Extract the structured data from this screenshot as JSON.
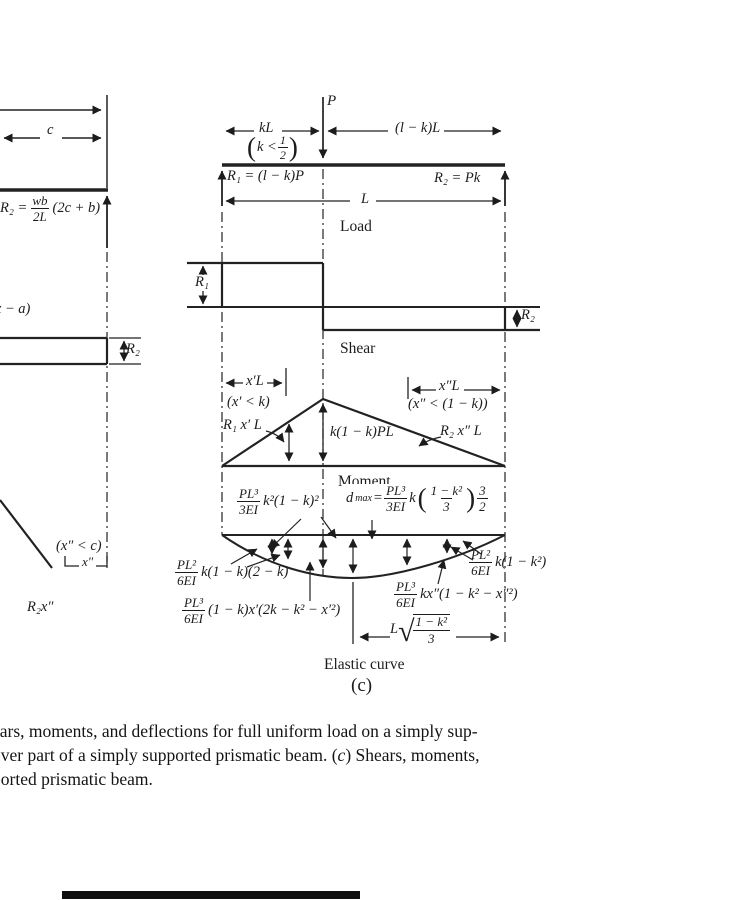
{
  "page": {
    "background": "#ffffff",
    "ink": "#1c1c1c"
  },
  "left_diagram": {
    "dim_c": "c",
    "r2_reaction": {
      "pre": "R₂ =",
      "num": "wb",
      "den": "2L",
      "post": "(2c + b)"
    },
    "x_minus_a": "(x − a)",
    "shear_r2": "R₂",
    "x2_condition": "(x″ < c)",
    "x2_dim": "x″",
    "moment_tail": "R₂x″"
  },
  "beam_diagram": {
    "load_p": "P",
    "dim_kl": "kL",
    "dim_lkl": "(l − k)L",
    "k_condition": {
      "open": "(",
      "body": "k <",
      "num": "1",
      "den": "2",
      "close": ")"
    },
    "r1_reaction": "R₁ = (l − k)P",
    "r2_reaction": "R₂ = Pk",
    "dim_l": "L",
    "label": "Load"
  },
  "shear_diagram": {
    "r1": "R₁",
    "r2": "R₂",
    "label": "Shear"
  },
  "moment_diagram": {
    "dim_x1l": "x′L",
    "x1_condition": "(x′ < k)",
    "left_value": "R₁ x′ L",
    "peak_value": "k(1 − k)PL",
    "dim_x2l": "x″L",
    "x2_condition": "(x″ < (1 − k))",
    "right_value": "R₂ x″ L",
    "label": "Moment"
  },
  "elastic_curve": {
    "defl_left": {
      "num": "PL³",
      "den": "3EI",
      "post": "k²(1 − k)²"
    },
    "dmax": {
      "base": "d",
      "sub": "max",
      "eq": "=",
      "num": "PL³",
      "den": "3EI",
      "coef": "k",
      "open": "(",
      "pnum": "1 − k²",
      "pden": "3",
      "close": ")",
      "enum": "3",
      "eden": "2"
    },
    "slope_left": {
      "num": "PL²",
      "den": "6EI",
      "post": "k(1 − k)(2 − k)"
    },
    "defl_x1": {
      "num": "PL³",
      "den": "6EI",
      "post": "(1 − k)x′(2k − k² − x′²)"
    },
    "defl_x2": {
      "num": "PL³",
      "den": "6EI",
      "post": "kx″(1 − k² − x″²)"
    },
    "slope_right": {
      "num": "PL²",
      "den": "6EI",
      "post": "k(1 − k²)"
    },
    "dmax_location": {
      "pre": "L",
      "radical": "√",
      "num": "1 − k²",
      "den": "3"
    },
    "label": "Elastic curve",
    "figure_label": "(c)"
  },
  "caption": {
    "line1": "ears, moments, and deflections for full uniform load on a simply sup-",
    "line2_pre": "over part of a simply supported prismatic beam. (",
    "line2_c": "c",
    "line2_post": ") Shears, moments,",
    "line3": "ported prismatic beam."
  }
}
